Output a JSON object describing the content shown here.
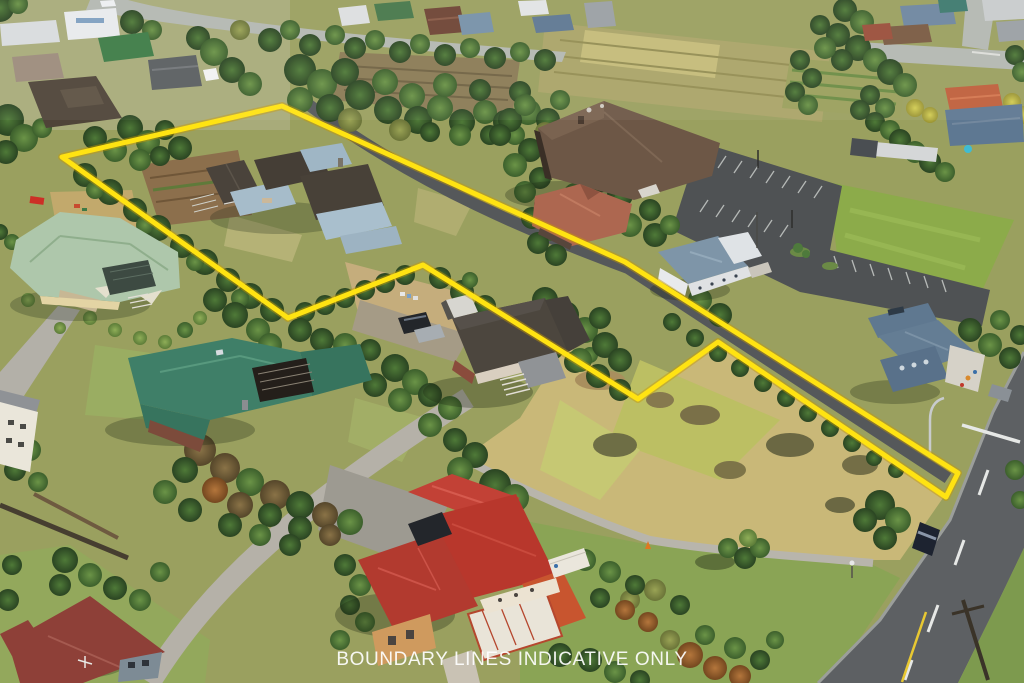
{
  "caption": {
    "text": "BOUNDARY LINES INDICATIVE ONLY",
    "color": "#ffffff"
  },
  "boundary": {
    "points": "282,106 625,262 958,473 946,497 718,342 638,399 423,265 288,318 62,157",
    "color": "#ffe312",
    "halo_color": "#c79a00"
  },
  "palette": {
    "dry_paddock": "#c9b878",
    "green_field": "#8cab4a",
    "asphalt_road": "#5d6063",
    "parking_lot": "#4f5254",
    "concrete_drive": "#b5b1a8",
    "hall_roof": "#6d5746",
    "teal_roof": "#3f7f68",
    "mint_roof": "#aec7ab",
    "red_roof": "#c0392b",
    "maroon_roof": "#8e4038",
    "blue_gray_roof": "#7e95a8"
  }
}
